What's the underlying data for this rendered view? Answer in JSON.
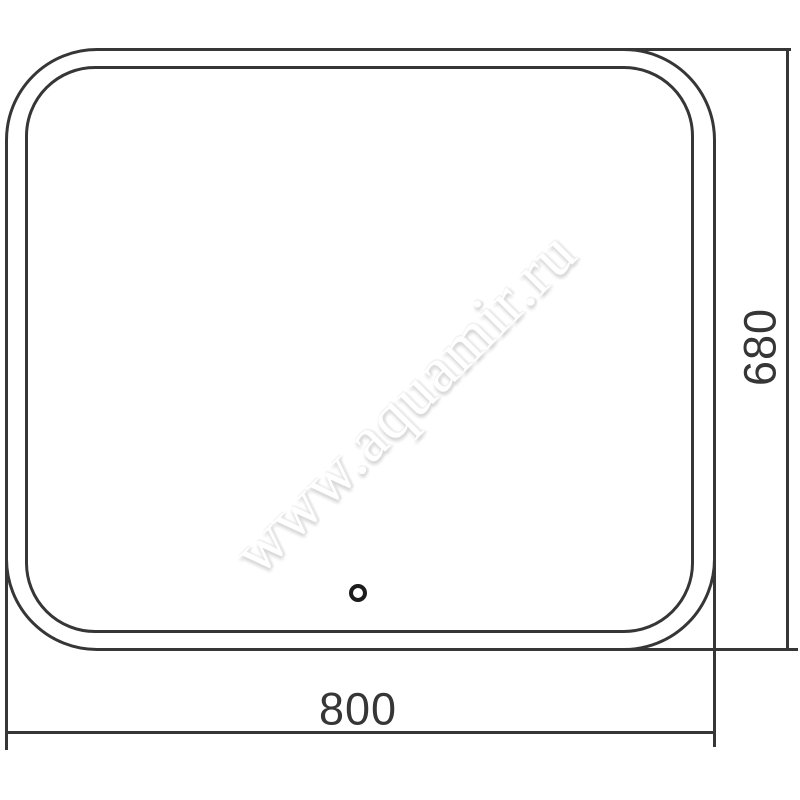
{
  "drawing": {
    "type": "technical-dimension-drawing",
    "subject": "rounded rectangular mirror, front view",
    "watermark_text": "www.aquamir.ru",
    "dimensions": {
      "width_label": "800",
      "height_label": "680"
    },
    "features": {
      "touch_sensor": "small circular sensor dot near bottom center of mirror"
    },
    "colors": {
      "line": "#363636",
      "background": "#ffffff",
      "watermark_shadow": "#d6d6d6"
    }
  }
}
